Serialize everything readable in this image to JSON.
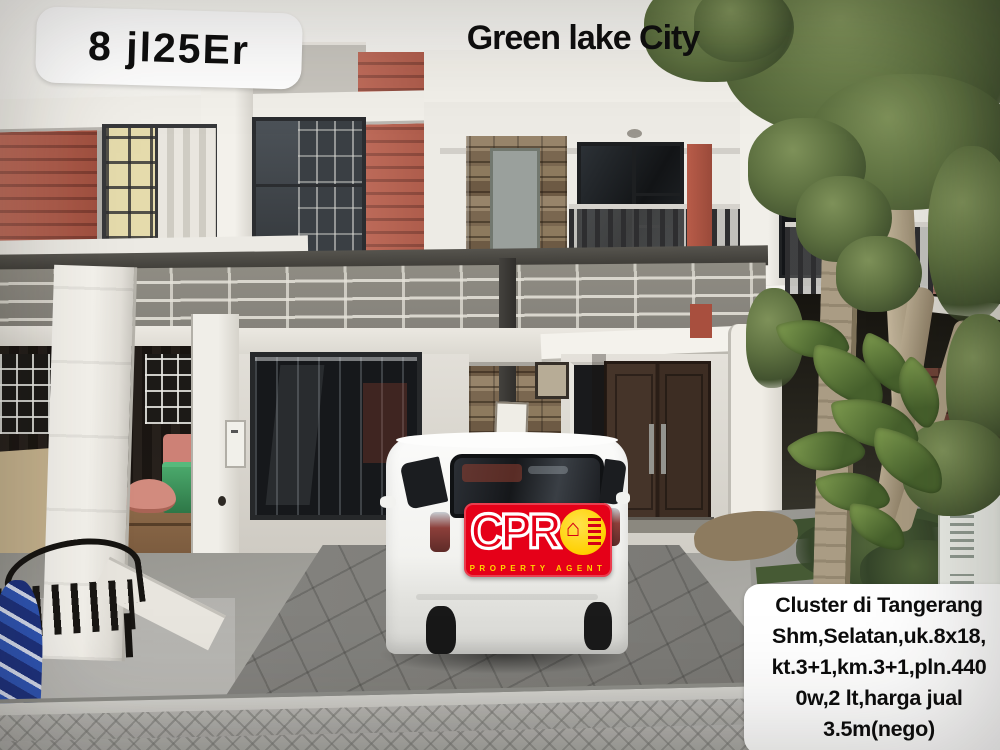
{
  "photo": {
    "listing_code": "8 jl25Er",
    "location_title": "Green lake City",
    "info_box_lines": [
      "Cluster di Tangerang",
      "Shm,Selatan,uk.8x18,",
      "kt.3+1,km.3+1,pln.440",
      "0w,2 lt,harga jual",
      "3.5m(nego)"
    ],
    "agency_logo": {
      "brand_letters": "CPR",
      "house_glyph": "⌂",
      "tagline": "PROPERTY AGENT",
      "colors": {
        "logo_red": "#e50018",
        "logo_yellow": "#ffd400"
      }
    }
  }
}
